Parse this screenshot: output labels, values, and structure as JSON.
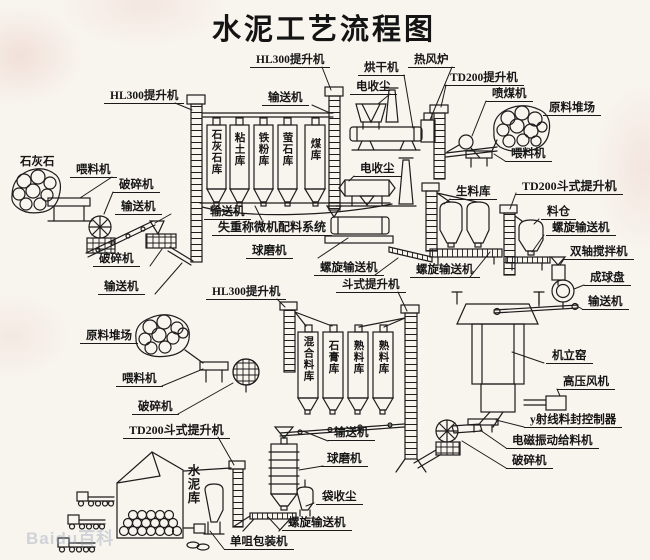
{
  "title": "水泥工艺流程图",
  "watermark": "Baidu百科",
  "colors": {
    "ink": "#1c1c1c",
    "paper": "#f8f4ee"
  },
  "labels": {
    "hl300_left": "HL300提升机",
    "hl300_mid": "HL300提升机",
    "hl300_bottom": "HL300提升机",
    "conveyor_top": "输送机",
    "conveyor_left_1": "输送机",
    "conveyor_left_2": "输送机",
    "conveyor_silos": "输送机",
    "conveyor_right": "输送机",
    "conveyor_bottom": "输送机",
    "dryer": "烘干机",
    "hot_stove": "热风炉",
    "edust_top": "电收尘",
    "edust_mid": "电收尘",
    "td200_top": "TD200提升机",
    "td200_right": "TD200斗式提升机",
    "td200_bottom_left": "TD200斗式提升机",
    "coal_injector": "喷煤机",
    "yard_top_right": "原料堆场",
    "yard_left": "原料堆场",
    "feeder_top_right": "喂料机",
    "feeder_left": "喂料机",
    "feeder_bottom": "喂料机",
    "limestone": "石灰石",
    "crusher_left_1": "破碎机",
    "crusher_left_2": "破碎机",
    "crusher_bottom_left": "破碎机",
    "crusher_kiln": "破碎机",
    "batching_system": "失重称微机配料系统",
    "raw_meal_silo": "生料库",
    "ball_mill_raw": "球磨机",
    "ball_mill_cement": "球磨机",
    "screw_mid": "螺旋输送机",
    "screw_rawsilo": "螺旋输送机",
    "screw_right": "螺旋输送机",
    "screw_bottom": "螺旋输送机",
    "bucket_elevator_mid": "斗式提升机",
    "hopper": "料仓",
    "mixer": "双轴搅拌机",
    "ball_disc": "成球盘",
    "kiln": "机立窑",
    "hp_fan": "高压风机",
    "gamma_controller": "y射线料封控制器",
    "vib_feeder": "电磁振动给料机",
    "bag_dust": "袋收尘",
    "packer": "单咀包装机",
    "cement_silo": "水泥库"
  },
  "raw_silos": [
    "石灰石库",
    "粘土库",
    "铁粉库",
    "萤石库",
    "煤库"
  ],
  "mid_silos": [
    "混合料库",
    "石膏库",
    "熟料库",
    "熟料库"
  ]
}
